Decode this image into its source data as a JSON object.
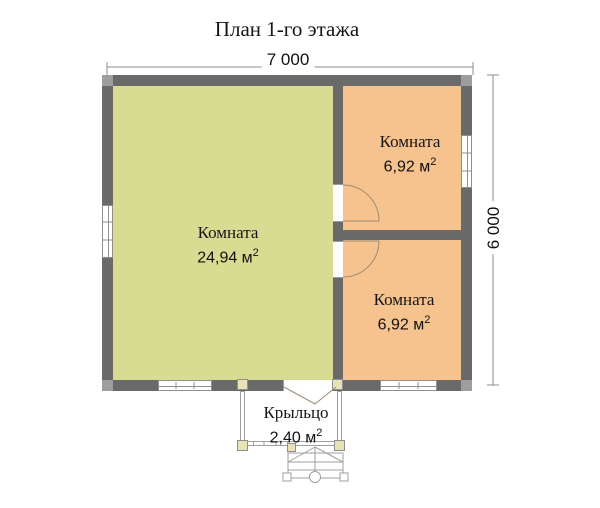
{
  "title": "План 1-го этажа",
  "dimensions": {
    "width_label": "7 000",
    "height_label": "6 000"
  },
  "rooms": {
    "living": {
      "name": "Комната",
      "area": "24,94 м",
      "area_sup": "2"
    },
    "bedroom_top": {
      "name": "Комната",
      "area": "6,92 м",
      "area_sup": "2"
    },
    "bedroom_bottom": {
      "name": "Комната",
      "area": "6,92 м",
      "area_sup": "2"
    },
    "porch": {
      "name": "Крыльцо",
      "area": "2,40 м",
      "area_sup": "2"
    }
  },
  "colors": {
    "wall": "#6a6a6a",
    "living": "#d8db92",
    "bedroom": "#f6c28e",
    "post": "#e7e3b6",
    "line": "#9f9f9f",
    "dim": "#8c8c8c"
  }
}
